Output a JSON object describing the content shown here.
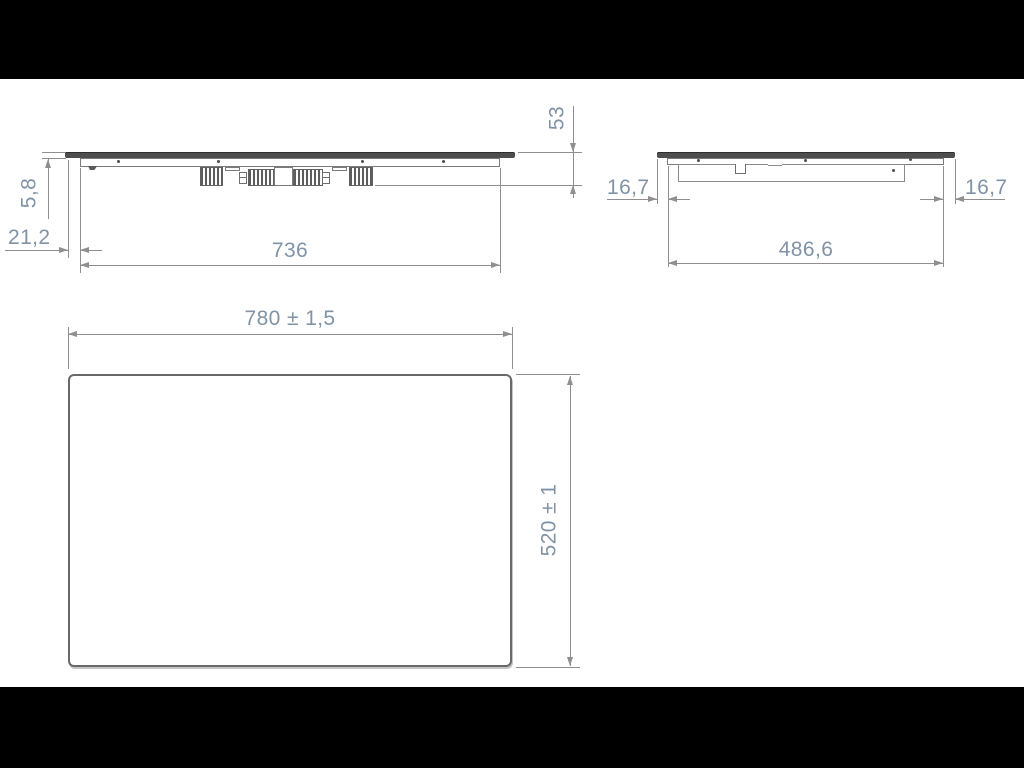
{
  "colors": {
    "background": "#ffffff",
    "letterbox": "#000000",
    "drawing_line": "#8f8f8f",
    "part_outline": "#7b7b7b",
    "glass_fill": "#4e4e4e",
    "dimension_text": "#8093a6"
  },
  "labels": {
    "glass_thickness": "5,8",
    "glass_overhang": "21,2",
    "body_width": "736",
    "total_height": "53",
    "end_left_inset": "16,7",
    "end_right_inset": "16,7",
    "end_body_width": "486,6",
    "top_width": "780 ± 1,5",
    "top_depth": "520 ± 1"
  },
  "dimensions": [
    {
      "view": "front-elevation",
      "value": "5,8",
      "orientation": "vertical"
    },
    {
      "view": "front-elevation",
      "value": "21,2",
      "orientation": "horizontal"
    },
    {
      "view": "front-elevation",
      "value": "736",
      "orientation": "horizontal"
    },
    {
      "view": "front-elevation",
      "value": "53",
      "orientation": "vertical"
    },
    {
      "view": "end-elevation",
      "value": "16,7",
      "orientation": "horizontal"
    },
    {
      "view": "end-elevation",
      "value": "486,6",
      "orientation": "horizontal"
    },
    {
      "view": "end-elevation",
      "value": "16,7",
      "orientation": "horizontal"
    },
    {
      "view": "plan-view",
      "value": "780 ± 1,5",
      "orientation": "horizontal"
    },
    {
      "view": "plan-view",
      "value": "520 ± 1",
      "orientation": "vertical"
    }
  ]
}
